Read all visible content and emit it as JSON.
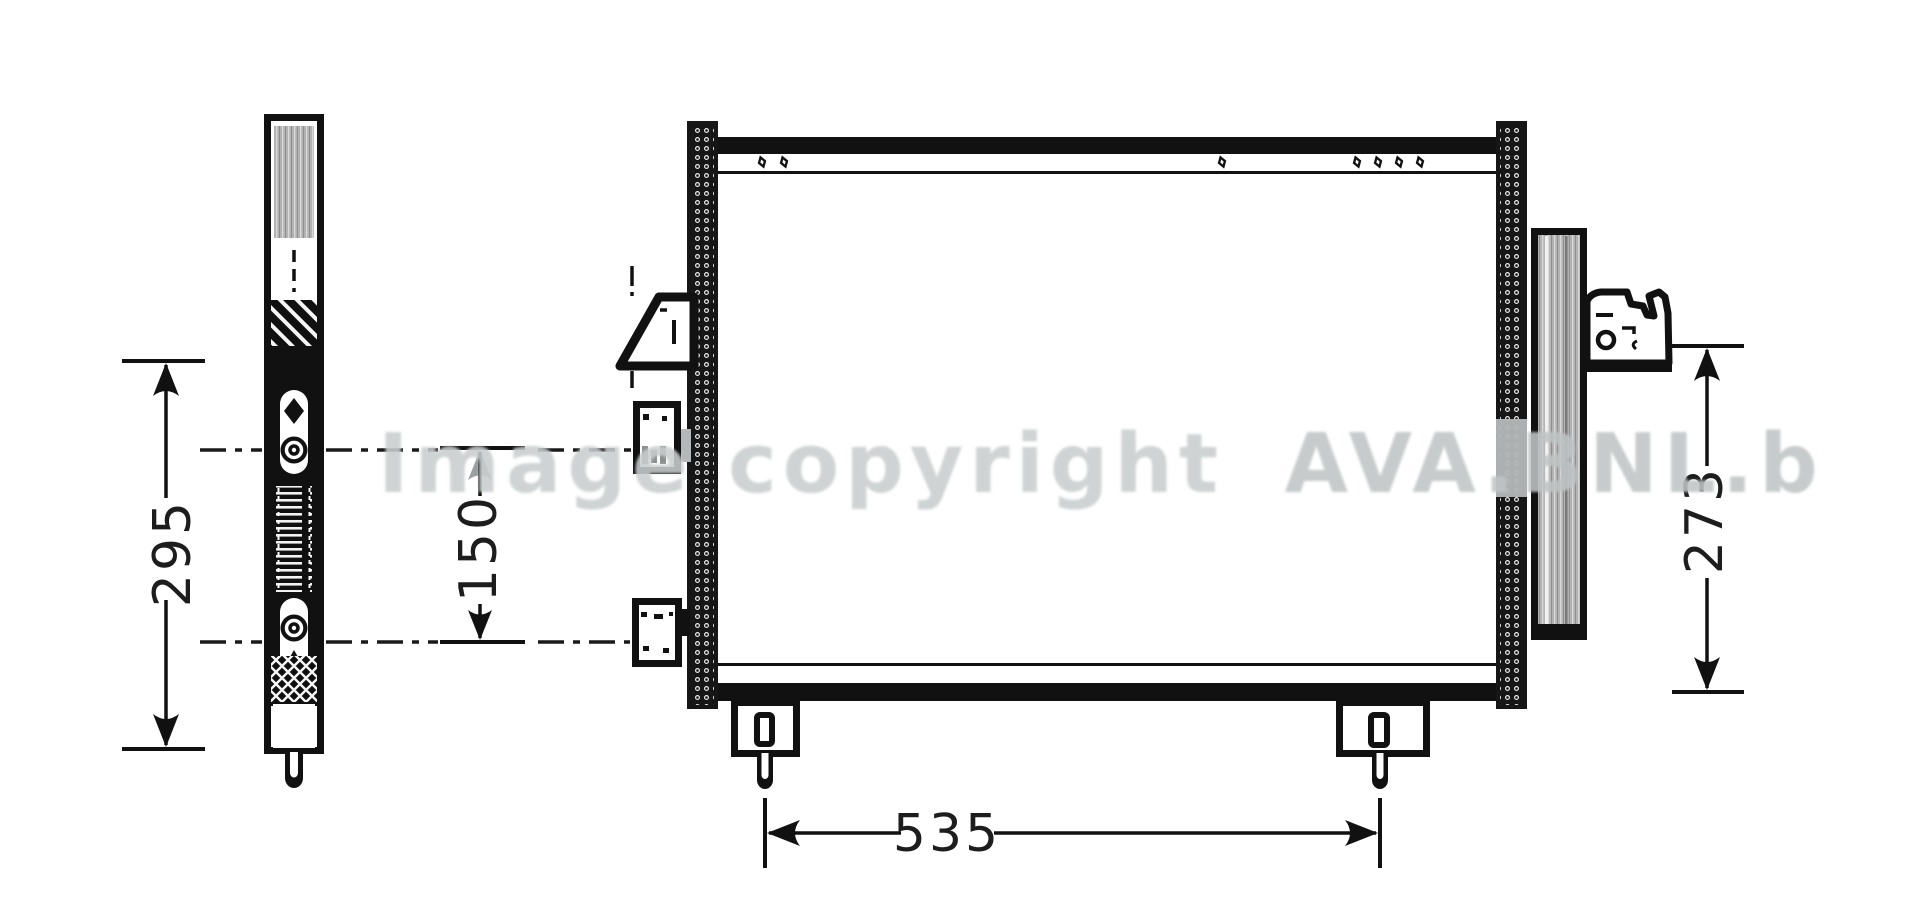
{
  "title": "Condenser technical drawing",
  "watermark": {
    "prefix": "Image copyright",
    "brand": "AVA.BNL.b",
    "color": "#c7cbcb"
  },
  "dimensions": {
    "drier_height": "295",
    "port_spacing": "150",
    "side_height": "273",
    "mount_spacing": "535"
  },
  "colors": {
    "line": "#111111",
    "fins_gray": "#b3b3b3",
    "wash_gray": "#b3b7b7",
    "background": "#ffffff"
  }
}
